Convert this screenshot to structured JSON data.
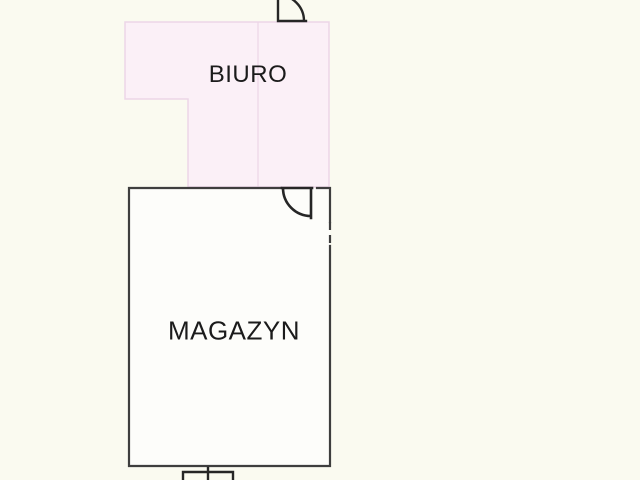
{
  "plan": {
    "rooms": [
      {
        "name": "biuro",
        "label": "BIURO"
      },
      {
        "name": "magazyn",
        "label": "MAGAZYN"
      }
    ],
    "features": [
      {
        "name": "door-swing-top",
        "type": "door-arc"
      },
      {
        "name": "door-swing-magazyn",
        "type": "door-arc"
      },
      {
        "name": "wall-opening",
        "type": "dashed-wall-segment"
      },
      {
        "name": "entrance-step",
        "type": "small-rectangle-bottom"
      }
    ]
  },
  "colors": {
    "background": "#fafaf0",
    "biuro_fill": "#fbf0f7",
    "biuro_border": "#ecd6e7",
    "magazyn_fill": "#fdfdfa",
    "wall": "#3e3e3e",
    "door": "#262626",
    "text": "#1b1b1b"
  }
}
